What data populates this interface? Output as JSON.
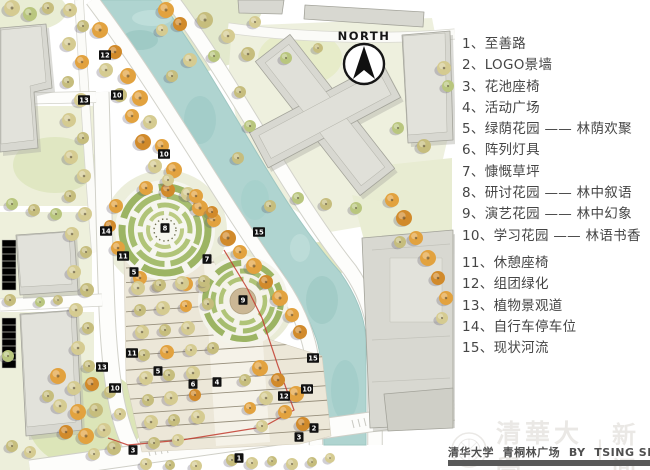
{
  "north_label": "NORTH",
  "legend": {
    "items": [
      "1、至善路",
      "2、LOGO景墙",
      "3、花池座椅",
      "4、活动广场",
      "5、绿荫花园 —— 林荫欢聚",
      "6、阵列灯具",
      "7、慷慨草坪",
      "8、研讨花园 —— 林中叙语",
      "9、演艺花园 —— 林中幻象",
      "10、学习花园 —— 林语书香",
      "11、休憩座椅",
      "12、组团绿化",
      "13、植物景观道",
      "14、自行车停车位",
      "15、现状河流"
    ]
  },
  "footer": {
    "credit": "清华大学  青桐林广场  BY  TSING SHANG",
    "watermark_cn": "清華大學",
    "watermark_divider": "|",
    "watermark_news": "新闻"
  },
  "map": {
    "markers": [
      {
        "n": "12",
        "x": 105,
        "y": 55
      },
      {
        "n": "13",
        "x": 84,
        "y": 100
      },
      {
        "n": "10",
        "x": 117,
        "y": 95
      },
      {
        "n": "10",
        "x": 164,
        "y": 154
      },
      {
        "n": "14",
        "x": 106,
        "y": 231
      },
      {
        "n": "8",
        "x": 165,
        "y": 228
      },
      {
        "n": "15",
        "x": 259,
        "y": 232
      },
      {
        "n": "7",
        "x": 207,
        "y": 259
      },
      {
        "n": "11",
        "x": 123,
        "y": 256
      },
      {
        "n": "5",
        "x": 134,
        "y": 272
      },
      {
        "n": "9",
        "x": 243,
        "y": 300
      },
      {
        "n": "15",
        "x": 313,
        "y": 358
      },
      {
        "n": "11",
        "x": 132,
        "y": 353
      },
      {
        "n": "13",
        "x": 102,
        "y": 367
      },
      {
        "n": "5",
        "x": 158,
        "y": 371
      },
      {
        "n": "6",
        "x": 193,
        "y": 384
      },
      {
        "n": "4",
        "x": 217,
        "y": 382
      },
      {
        "n": "10",
        "x": 115,
        "y": 388
      },
      {
        "n": "10",
        "x": 307,
        "y": 389
      },
      {
        "n": "12",
        "x": 284,
        "y": 396
      },
      {
        "n": "2",
        "x": 314,
        "y": 428
      },
      {
        "n": "3",
        "x": 299,
        "y": 437
      },
      {
        "n": "3",
        "x": 133,
        "y": 450
      },
      {
        "n": "1",
        "x": 239,
        "y": 458
      }
    ]
  },
  "colors": {
    "river": "#afd4d0",
    "grass": "#e9edd4",
    "building": "#d8d8d1",
    "ring_green": "#9cb463",
    "tree_orange": "#e2a23f",
    "tree_tan": "#d5cb91",
    "accent_red": "#c23b2e",
    "marker_bg": "#111111",
    "footer_bar": "#585858"
  }
}
